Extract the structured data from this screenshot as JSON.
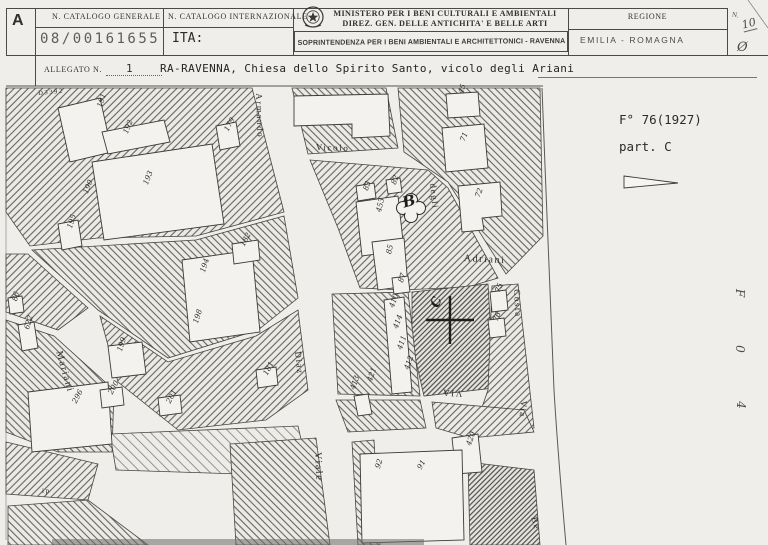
{
  "header": {
    "section_letter": "A",
    "catalogo_generale": {
      "label": "N. CATALOGO GENERALE",
      "value": "08/00161655"
    },
    "catalogo_internazionale": {
      "label": "N. CATALOGO INTERNAZIONALE",
      "value": "ITA:"
    },
    "ministero_line1": "MINISTERO PER I BENI CULTURALI E AMBIENTALI",
    "ministero_line2": "DIREZ. GEN. DELLE ANTICHITA' E BELLE ARTI",
    "soprintendenza_stamp": "SOPRINTENDENZA PER I BENI AMBIENTALI E ARCHITETTONICI - RAVENNA",
    "regione": {
      "label": "REGIONE",
      "value": "EMILIA - ROMAGNA"
    },
    "margin": {
      "n_label": "N.",
      "n_value": "10",
      "circle_value": "Ø"
    }
  },
  "allegato": {
    "label": "ALLEGATO N.",
    "number": "1",
    "title": "RA-RAVENNA, Chiesa dello Spirito Santo, vicolo degli Ariani"
  },
  "map_annotation": {
    "foglio": "F° 76(1927)",
    "particella": "part. C"
  },
  "margin_notes": {
    "vertical_chars": [
      "F",
      "0",
      "4"
    ]
  },
  "map": {
    "street_labels": [
      {
        "text": "Armando",
        "x": 263,
        "y": 93,
        "rot": 88,
        "size": 9
      },
      {
        "text": "Vicolo",
        "x": 316,
        "y": 143,
        "rot": 2,
        "size": 9
      },
      {
        "text": "degli",
        "x": 437,
        "y": 183,
        "rot": 84,
        "size": 9
      },
      {
        "text": "Adriani",
        "x": 464,
        "y": 254,
        "rot": 3,
        "size": 10
      },
      {
        "text": "Costa",
        "x": 521,
        "y": 289,
        "rot": 87,
        "size": 9
      },
      {
        "text": "Diaz",
        "x": 302,
        "y": 351,
        "rot": 84,
        "size": 9
      },
      {
        "text": "VIA",
        "x": 462,
        "y": 398,
        "rot": 184,
        "size": 9
      },
      {
        "text": "Via",
        "x": 528,
        "y": 401,
        "rot": 95,
        "size": 9
      },
      {
        "text": "Viale",
        "x": 322,
        "y": 452,
        "rot": 87,
        "size": 10
      },
      {
        "text": "Mariani",
        "x": 63,
        "y": 350,
        "rot": 74,
        "size": 10
      },
      {
        "text": "Be",
        "x": 538,
        "y": 516,
        "rot": 75,
        "size": 9
      },
      {
        "text": "ip",
        "x": 42,
        "y": 488,
        "rot": 0,
        "size": 7
      },
      {
        "text": "D3392",
        "x": 38,
        "y": 91,
        "rot": -5,
        "size": 6.5
      }
    ],
    "parcel_labels": [
      {
        "text": "191",
        "x": 96,
        "y": 106,
        "rot": -72
      },
      {
        "text": "192",
        "x": 122,
        "y": 132,
        "rot": -68
      },
      {
        "text": "193",
        "x": 142,
        "y": 183,
        "rot": -68
      },
      {
        "text": "190",
        "x": 82,
        "y": 192,
        "rot": -68
      },
      {
        "text": "195",
        "x": 66,
        "y": 227,
        "rot": -72
      },
      {
        "text": "179",
        "x": 223,
        "y": 129,
        "rot": -62
      },
      {
        "text": "194",
        "x": 199,
        "y": 271,
        "rot": -72
      },
      {
        "text": "198",
        "x": 192,
        "y": 322,
        "rot": -72
      },
      {
        "text": "182",
        "x": 239,
        "y": 244,
        "rot": -62
      },
      {
        "text": "199",
        "x": 116,
        "y": 350,
        "rot": -72
      },
      {
        "text": "200",
        "x": 107,
        "y": 392,
        "rot": -62
      },
      {
        "text": "201",
        "x": 165,
        "y": 401,
        "rot": -62
      },
      {
        "text": "296",
        "x": 71,
        "y": 401,
        "rot": -62
      },
      {
        "text": "622",
        "x": 23,
        "y": 328,
        "rot": -72
      },
      {
        "text": "86",
        "x": 11,
        "y": 300,
        "rot": -75
      },
      {
        "text": "453",
        "x": 375,
        "y": 211,
        "rot": -76
      },
      {
        "text": "83",
        "x": 362,
        "y": 189,
        "rot": -70
      },
      {
        "text": "82",
        "x": 390,
        "y": 183,
        "rot": -70
      },
      {
        "text": "85",
        "x": 385,
        "y": 253,
        "rot": -76
      },
      {
        "text": "87",
        "x": 397,
        "y": 281,
        "rot": -70
      },
      {
        "text": "410",
        "x": 388,
        "y": 306,
        "rot": -70
      },
      {
        "text": "414",
        "x": 392,
        "y": 327,
        "rot": -70
      },
      {
        "text": "411",
        "x": 396,
        "y": 348,
        "rot": -70
      },
      {
        "text": "412",
        "x": 403,
        "y": 368,
        "rot": -70
      },
      {
        "text": "421",
        "x": 366,
        "y": 380,
        "rot": -70
      },
      {
        "text": "413",
        "x": 349,
        "y": 388,
        "rot": -70
      },
      {
        "text": "45",
        "x": 457,
        "y": 92,
        "rot": -70
      },
      {
        "text": "71",
        "x": 459,
        "y": 140,
        "rot": -70
      },
      {
        "text": "72",
        "x": 474,
        "y": 196,
        "rot": -70
      },
      {
        "text": "75",
        "x": 494,
        "y": 291,
        "rot": -70
      },
      {
        "text": "76",
        "x": 492,
        "y": 320,
        "rot": -70
      },
      {
        "text": "420",
        "x": 465,
        "y": 444,
        "rot": -70
      },
      {
        "text": "91",
        "x": 416,
        "y": 467,
        "rot": -62
      },
      {
        "text": "92",
        "x": 374,
        "y": 467,
        "rot": -72
      },
      {
        "text": "181",
        "x": 262,
        "y": 373,
        "rot": -62
      }
    ],
    "markers": [
      {
        "text": "B",
        "x": 401,
        "y": 196,
        "rot": -15,
        "size": 15
      },
      {
        "text": "C",
        "x": 429,
        "y": 305,
        "rot": -70,
        "size": 13
      }
    ]
  },
  "colors": {
    "paper": "#efeeea",
    "ink": "#2f2e2c",
    "hatch": "#5f5f5c"
  }
}
